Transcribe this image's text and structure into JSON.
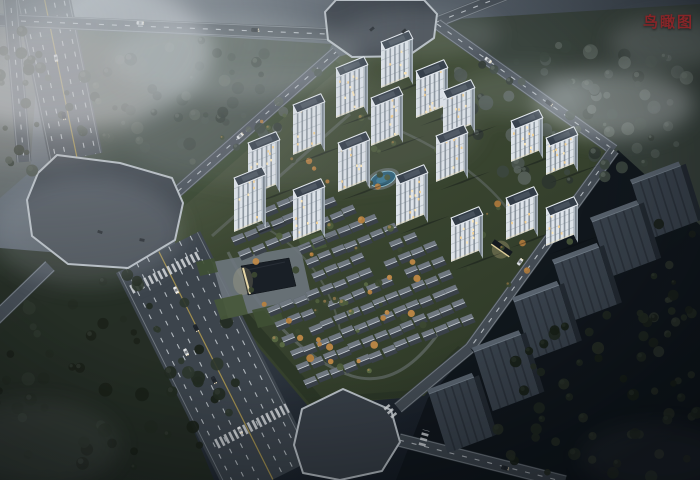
{
  "header": {
    "label": "鸟瞰图"
  },
  "palette": {
    "label_red": "#872528",
    "facade": "#dde3e9",
    "facade_side": "#b0bac4",
    "roof": "#323c47",
    "roof_rim": "#e6ebf0",
    "lit_window": "#f6d190",
    "lit_warm": "#ffe9b8",
    "asphalt": "#3c444c",
    "lane_dash": "#ced4d9",
    "center_yellow": "#b39c4e",
    "plaza": "#3d444c",
    "greenery": "#3b4830",
    "water": "#2f6077",
    "slab_face": "#39424c",
    "slab_rib": "#2c333c",
    "slab_top": "#59636e",
    "fog": "#d4dade"
  },
  "scene": {
    "viewport": {
      "w": 700,
      "h": 480
    },
    "axes": {
      "u": [
        0.927,
        -0.375
      ],
      "v": [
        0.454,
        0.891
      ]
    },
    "terrain": [
      {
        "name": "ground-top-woods",
        "points": [
          [
            50,
            26
          ],
          [
            332,
            44
          ],
          [
            324,
            62
          ],
          [
            174,
            196
          ],
          [
            60,
            152
          ]
        ],
        "fill": "#414c44",
        "o": 0.9
      },
      {
        "name": "ground-forest-topright",
        "points": [
          [
            440,
            20
          ],
          [
            700,
            4
          ],
          [
            700,
            236
          ],
          [
            628,
            178
          ],
          [
            450,
            30
          ]
        ],
        "fill": "#39433c",
        "o": 0.92
      },
      {
        "name": "ground-left-strip",
        "points": [
          [
            0,
            0
          ],
          [
            42,
            0
          ],
          [
            30,
            172
          ],
          [
            0,
            198
          ]
        ],
        "fill": "#575e56",
        "o": 0.5
      },
      {
        "name": "ground-field-bottomleft",
        "points": [
          [
            0,
            248
          ],
          [
            122,
            258
          ],
          [
            214,
            480
          ],
          [
            0,
            480
          ]
        ],
        "fill": "#242c23",
        "o": 0.95
      },
      {
        "name": "ground-dark-bottomright",
        "points": [
          [
            618,
            150
          ],
          [
            700,
            225
          ],
          [
            700,
            480
          ],
          [
            396,
            480
          ],
          [
            428,
            398
          ],
          [
            472,
            348
          ]
        ],
        "fill": "#10161b",
        "o": 0.95
      }
    ],
    "parcel": {
      "points": [
        [
          170,
          203
        ],
        [
          334,
          58
        ],
        [
          437,
          30
        ],
        [
          614,
          150
        ],
        [
          468,
          348
        ],
        [
          424,
          396
        ],
        [
          308,
          406
        ],
        [
          176,
          250
        ]
      ]
    },
    "hedges": [
      {
        "name": "hedge-southwest",
        "points": [
          [
            178,
            248
          ],
          [
            310,
            404
          ],
          [
            322,
            398
          ],
          [
            190,
            246
          ]
        ],
        "fill": "#2a3526",
        "o": 0.9
      },
      {
        "name": "hedge-south",
        "points": [
          [
            310,
            404
          ],
          [
            422,
            396
          ],
          [
            466,
            350
          ],
          [
            458,
            346
          ],
          [
            414,
            390
          ],
          [
            312,
            398
          ]
        ],
        "fill": "#2a3526",
        "o": 0.85
      },
      {
        "name": "hedge-northwest",
        "points": [
          [
            172,
            202
          ],
          [
            334,
            60
          ],
          [
            342,
            66
          ],
          [
            182,
            208
          ]
        ],
        "fill": "#33422c",
        "o": 0.8
      }
    ],
    "paths": [
      {
        "d": "M228,252 C252,302 302,360 352,376 C392,388 422,358 442,328",
        "stroke": "#80888e",
        "w": 3,
        "o": 0.45
      },
      {
        "d": "M212,236 L350,114",
        "stroke": "#80888e",
        "w": 3,
        "o": 0.35
      },
      {
        "d": "M368,118 C452,148 502,192 522,232",
        "stroke": "#80888e",
        "w": 2.5,
        "o": 0.35
      },
      {
        "d": "M238,214 C300,240 330,280 340,330",
        "stroke": "#8a9196",
        "w": 2,
        "o": 0.3
      }
    ],
    "roads": [
      {
        "name": "road-topleft-artery",
        "x1": 42,
        "y1": -8,
        "x2": 76,
        "y2": 158,
        "w": 54,
        "fill": "#4c545c",
        "dashes": [
          -20,
          -10,
          10,
          20
        ],
        "yellow": [
          -1
        ],
        "edges": 25
      },
      {
        "name": "road-top",
        "x1": -5,
        "y1": 20,
        "x2": 327,
        "y2": 34,
        "w": 13,
        "fill": "#474f57",
        "dashes": [
          0
        ],
        "edges": 5.5
      },
      {
        "name": "road-top-right",
        "x1": 437,
        "y1": 22,
        "x2": 508,
        "y2": -6,
        "w": 12,
        "fill": "#474f57",
        "dashes": [
          0
        ],
        "edges": 5
      },
      {
        "name": "road-nw-boundary",
        "x1": 168,
        "y1": 200,
        "x2": 336,
        "y2": 52,
        "w": 12,
        "fill": "#49515a",
        "dashes": [
          0
        ],
        "edges": 5
      },
      {
        "name": "road-ne-boundary",
        "x1": 437,
        "y1": 24,
        "x2": 614,
        "y2": 150,
        "w": 12,
        "fill": "#49515a",
        "dashes": [
          0
        ],
        "edges": 5
      },
      {
        "name": "road-east-boundary",
        "x1": 614,
        "y1": 150,
        "x2": 470,
        "y2": 348,
        "w": 12,
        "fill": "#434b53",
        "dashes": [
          0
        ],
        "edges": 5
      },
      {
        "name": "road-east-lower",
        "x1": 470,
        "y1": 348,
        "x2": 398,
        "y2": 408,
        "w": 12,
        "fill": "#434b53",
        "edges": 5
      },
      {
        "name": "road-bottom-exit",
        "x1": 399,
        "y1": 440,
        "x2": 565,
        "y2": 482,
        "w": 14,
        "fill": "#3f474f",
        "dashes": [
          0
        ],
        "edges": 6
      },
      {
        "name": "road-left-edge",
        "x1": 10,
        "y1": -5,
        "x2": 24,
        "y2": 162,
        "w": 15,
        "fill": "#4c545c",
        "dashes": [
          0
        ],
        "edges": 6
      },
      {
        "name": "road-sw-exit",
        "x1": 50,
        "y1": 266,
        "x2": -8,
        "y2": 322,
        "w": 14,
        "fill": "#454d55",
        "edges": 6
      },
      {
        "name": "road-highway",
        "x1": 158,
        "y1": 252,
        "x2": 272,
        "y2": 480,
        "w": 94,
        "fill": "#3c444c",
        "dashes": [
          -36,
          -24,
          -12,
          12,
          24,
          36
        ],
        "yellow": [
          -1
        ],
        "edges": 44
      }
    ],
    "octagons": [
      {
        "name": "plaza-west-intersection",
        "points": [
          [
            57,
            155
          ],
          [
            120,
            163
          ],
          [
            172,
            178
          ],
          [
            183,
            203
          ],
          [
            175,
            240
          ],
          [
            128,
            268
          ],
          [
            68,
            264
          ],
          [
            32,
            236
          ],
          [
            27,
            200
          ],
          [
            38,
            173
          ]
        ],
        "fill": "#3d444c"
      },
      {
        "name": "plaza-north-intersection",
        "points": [
          [
            336,
            0
          ],
          [
            424,
            0
          ],
          [
            437,
            14
          ],
          [
            434,
            38
          ],
          [
            408,
            56
          ],
          [
            352,
            57
          ],
          [
            328,
            40
          ],
          [
            325,
            12
          ]
        ],
        "fill": "#3d444c"
      },
      {
        "name": "plaza-south-intersection",
        "points": [
          [
            343,
            389
          ],
          [
            391,
            410
          ],
          [
            400,
            442
          ],
          [
            382,
            471
          ],
          [
            340,
            480
          ],
          [
            303,
            473
          ],
          [
            294,
            445
          ],
          [
            302,
            409
          ]
        ],
        "fill": "#373e46"
      }
    ],
    "zebras": [
      {
        "x": 166,
        "y": 272,
        "a": -27,
        "len": 78,
        "w": 9
      },
      {
        "x": 252,
        "y": 426,
        "a": -27,
        "len": 80,
        "w": 10
      },
      {
        "x": 391,
        "y": 412,
        "a": 50,
        "len": 15,
        "w": 7
      },
      {
        "x": 424,
        "y": 438,
        "a": -75,
        "len": 16,
        "w": 7
      }
    ],
    "plaza_club": {
      "points": [
        [
          212,
          262
        ],
        [
          300,
          246
        ],
        [
          312,
          300
        ],
        [
          228,
          318
        ]
      ],
      "fill": "#6d757d"
    },
    "lawns": [
      {
        "points": [
          [
            214,
            300
          ],
          [
            242,
            294
          ],
          [
            248,
            314
          ],
          [
            221,
            320
          ]
        ],
        "fill": "#47573a"
      },
      {
        "points": [
          [
            252,
            310
          ],
          [
            278,
            304
          ],
          [
            284,
            322
          ],
          [
            258,
            328
          ]
        ],
        "fill": "#3f4f34"
      },
      {
        "points": [
          [
            298,
            238
          ],
          [
            322,
            232
          ],
          [
            327,
            247
          ],
          [
            303,
            253
          ]
        ],
        "fill": "#47573a"
      },
      {
        "points": [
          [
            196,
            262
          ],
          [
            214,
            258
          ],
          [
            218,
            272
          ],
          [
            200,
            276
          ]
        ],
        "fill": "#3f4f34"
      }
    ],
    "clubhouse": {
      "points": [
        [
          241,
          266
        ],
        [
          289,
          258
        ],
        [
          296,
          286
        ],
        [
          248,
          295
        ]
      ],
      "lit_from": [
        243,
        268
      ],
      "lit_to": [
        250,
        294
      ]
    },
    "pool": {
      "cx": 383,
      "cy": 179,
      "rx": 13,
      "ry": 7,
      "rot": -20
    },
    "entrance_east": {
      "x": 502,
      "y": 248,
      "rot": 35,
      "w": 22,
      "h": 6
    },
    "towers": [
      [
        381,
        88,
        46
      ],
      [
        336,
        118,
        50
      ],
      [
        416,
        118,
        47
      ],
      [
        293,
        155,
        50
      ],
      [
        371,
        146,
        48
      ],
      [
        443,
        136,
        45
      ],
      [
        248,
        196,
        53
      ],
      [
        338,
        192,
        49
      ],
      [
        436,
        182,
        46
      ],
      [
        511,
        162,
        41
      ],
      [
        546,
        175,
        37
      ],
      [
        234,
        232,
        54
      ],
      [
        293,
        241,
        51
      ],
      [
        396,
        226,
        50
      ],
      [
        451,
        262,
        44
      ],
      [
        506,
        240,
        42
      ],
      [
        546,
        246,
        38
      ]
    ],
    "villas": {
      "ox": 238,
      "oy": 252,
      "iu": 14,
      "jv": 16,
      "imax": 12,
      "jmin": -2,
      "jmax": 9,
      "seed": 7
    },
    "slabs": [
      [
        632,
        184,
        52,
        58
      ],
      [
        592,
        222,
        50,
        58
      ],
      [
        554,
        264,
        48,
        60
      ],
      [
        514,
        302,
        48,
        60
      ],
      [
        474,
        352,
        50,
        62
      ],
      [
        429,
        394,
        48,
        62
      ]
    ],
    "tree_clusters": [
      {
        "name": "woods-top",
        "cx": 195,
        "cy": 100,
        "rx": 138,
        "ry": 62,
        "n": 70,
        "rmin": 2.5,
        "rmax": 6.5,
        "seed": 11,
        "colors": [
          "#47514b",
          "#3a443e",
          "#2f3832",
          "#515b54"
        ],
        "hl": "#5e685f",
        "layer": "back"
      },
      {
        "name": "forest-topright",
        "cx": 568,
        "cy": 108,
        "rx": 132,
        "ry": 78,
        "n": 85,
        "rmin": 3,
        "rmax": 7.5,
        "seed": 22,
        "colors": [
          "#4b554f",
          "#3c463f",
          "#2c352f",
          "#57615a"
        ],
        "hl": "#67716a",
        "layer": "back"
      },
      {
        "name": "strip-left",
        "cx": 22,
        "cy": 100,
        "rx": 28,
        "ry": 78,
        "n": 24,
        "rmin": 2.5,
        "rmax": 6,
        "seed": 33,
        "colors": [
          "#4a524b",
          "#3b433c",
          "#2f372f"
        ],
        "hl": "#59615a",
        "layer": "back"
      },
      {
        "name": "field-bottomleft",
        "cx": 108,
        "cy": 378,
        "rx": 140,
        "ry": 108,
        "n": 60,
        "rmin": 3,
        "rmax": 7,
        "seed": 44,
        "colors": [
          "#2d362c",
          "#232b22",
          "#1b2219"
        ],
        "hl": "#39423a",
        "layer": "back"
      },
      {
        "name": "garden-villas",
        "cx": 345,
        "cy": 295,
        "rx": 105,
        "ry": 80,
        "n": 46,
        "rmin": 1.8,
        "rmax": 4,
        "seed": 77,
        "colors": [
          "#4f5e3d",
          "#b9813f",
          "#3c4831",
          "#c28a46",
          "#5a6a44"
        ],
        "hl": "#c9985c",
        "layer": "mid"
      },
      {
        "name": "garden-north",
        "cx": 325,
        "cy": 150,
        "rx": 112,
        "ry": 48,
        "n": 30,
        "rmin": 1.6,
        "rmax": 3.4,
        "seed": 88,
        "colors": [
          "#4c5a3b",
          "#b27c3e",
          "#3a4630"
        ],
        "hl": "#c08e4e",
        "layer": "mid"
      },
      {
        "name": "garden-east",
        "cx": 512,
        "cy": 238,
        "rx": 58,
        "ry": 52,
        "n": 20,
        "rmin": 1.8,
        "rmax": 3.6,
        "seed": 99,
        "colors": [
          "#48563a",
          "#ad783c",
          "#38442f"
        ],
        "hl": "#bb8a4a",
        "layer": "mid"
      },
      {
        "name": "woods-bottomright",
        "cx": 602,
        "cy": 402,
        "rx": 118,
        "ry": 88,
        "n": 52,
        "rmin": 3,
        "rmax": 6.5,
        "seed": 55,
        "colors": [
          "#202820",
          "#181f17",
          "#262e24"
        ],
        "hl": "#2e372d",
        "layer": "front"
      },
      {
        "name": "strip-east",
        "cx": 668,
        "cy": 295,
        "rx": 40,
        "ry": 78,
        "n": 22,
        "rmin": 2.5,
        "rmax": 5.5,
        "seed": 66,
        "colors": [
          "#222a21",
          "#1a211a",
          "#2a322a"
        ],
        "hl": "#333b33",
        "layer": "front"
      }
    ],
    "cars": [
      [
        176,
        290,
        63,
        "#e9ebee"
      ],
      [
        196,
        328,
        63,
        "#21272d"
      ],
      [
        186,
        352,
        63,
        "#dfe3e6"
      ],
      [
        214,
        380,
        63,
        "#272d33"
      ],
      [
        240,
        430,
        63,
        "#e9ebee"
      ],
      [
        56,
        58,
        79,
        "#dde1e4"
      ],
      [
        64,
        116,
        79,
        "#272d33"
      ],
      [
        140,
        23,
        2,
        "#d9dde1"
      ],
      [
        255,
        30,
        2,
        "#23292f"
      ],
      [
        488,
        60,
        36,
        "#dde1e4"
      ],
      [
        549,
        103,
        36,
        "#23292f"
      ],
      [
        520,
        262,
        -55,
        "#d9dde1"
      ],
      [
        505,
        468,
        15,
        "#23292f"
      ],
      [
        240,
        136,
        -41,
        "#dde1e4"
      ]
    ],
    "parked": [
      [
        372,
        29,
        -40
      ],
      [
        404,
        31,
        -40
      ],
      [
        100,
        232,
        20
      ],
      [
        142,
        240,
        10
      ]
    ],
    "fog": [
      [
        62,
        52,
        150,
        78,
        0.5,
        "#d4dade"
      ],
      [
        235,
        58,
        125,
        42,
        0.26,
        "#ccd3d8"
      ],
      [
        420,
        35,
        80,
        26,
        0.16,
        "#ccd3d8"
      ],
      [
        614,
        104,
        80,
        34,
        0.42,
        "#d2d8dc"
      ],
      [
        668,
        42,
        58,
        26,
        0.22,
        "#ccd3d8"
      ],
      [
        520,
        92,
        70,
        26,
        0.16,
        "#ccd3d8"
      ],
      [
        88,
        232,
        95,
        55,
        0.16,
        "#c6cdd2"
      ],
      [
        35,
        445,
        85,
        45,
        0.1,
        "#c0c7cc"
      ],
      [
        655,
        458,
        75,
        35,
        0.08,
        "#b9c0c6"
      ],
      [
        36,
        96,
        110,
        70,
        0.15,
        "#c9b8ac"
      ],
      [
        300,
        130,
        180,
        60,
        0.1,
        "#c2c9ce"
      ]
    ]
  }
}
